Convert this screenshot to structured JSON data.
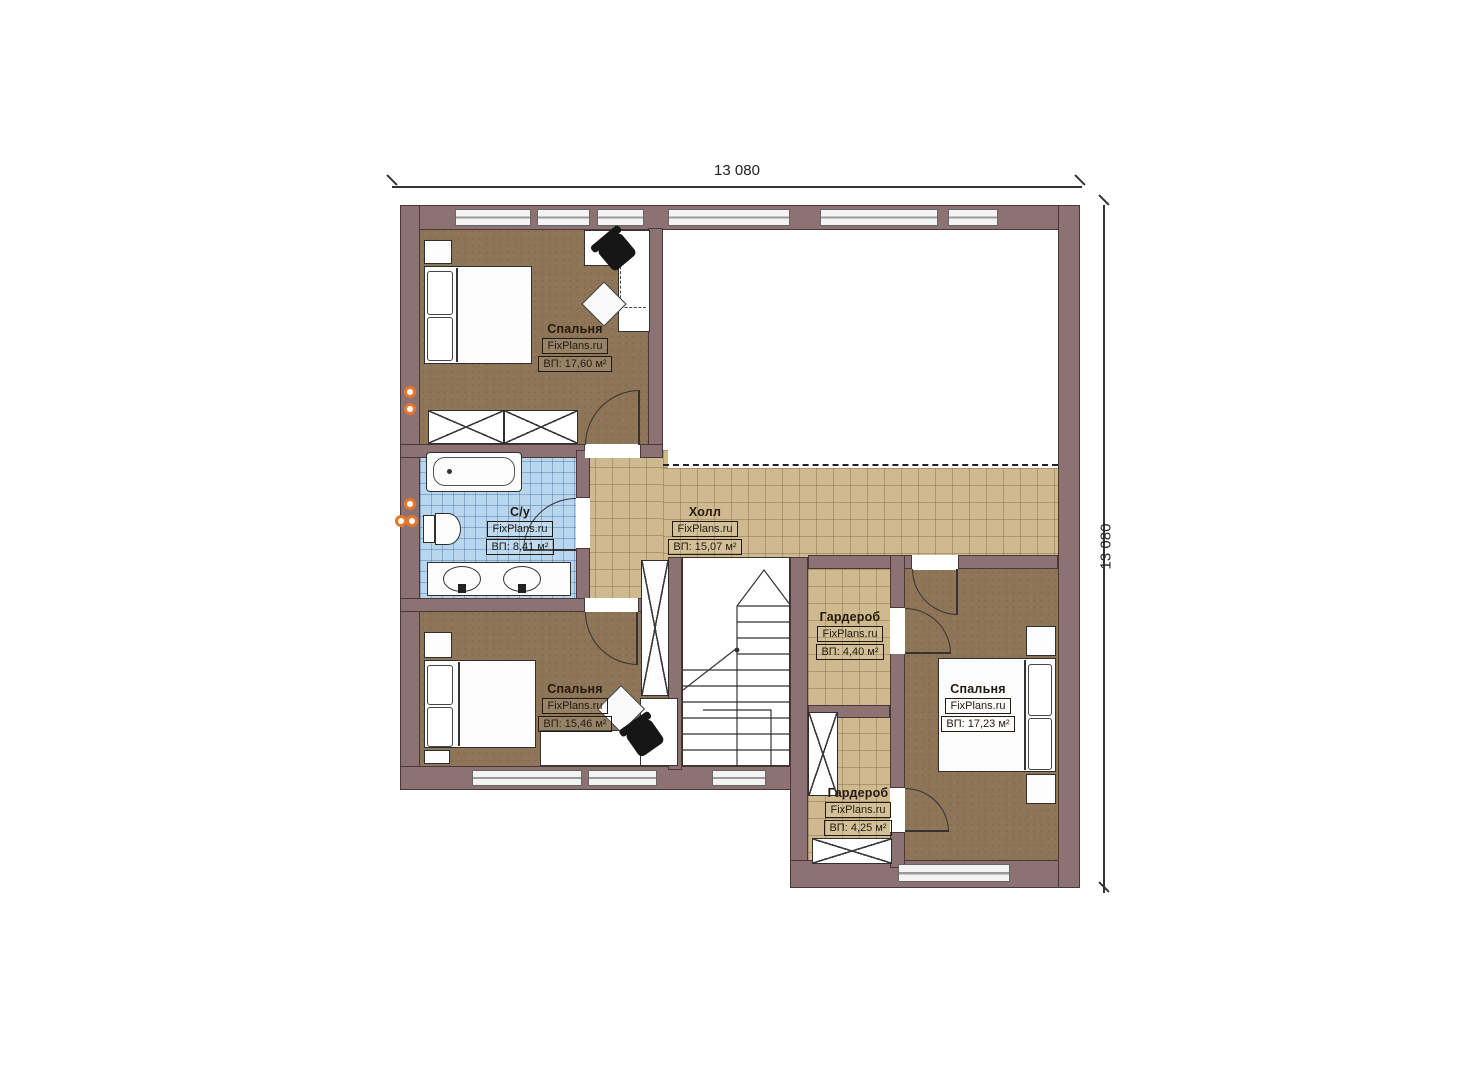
{
  "brand": "FixPlans.ru",
  "dimensions": {
    "top": "13 080",
    "right": "13 080"
  },
  "rooms": [
    {
      "key": "bedroom_top_left",
      "name": "Спальня",
      "brand": "FixPlans.ru",
      "area": "ВП: 17,60 м²"
    },
    {
      "key": "bathroom",
      "name": "С/у",
      "brand": "FixPlans.ru",
      "area": "ВП: 8,41 м²"
    },
    {
      "key": "hall",
      "name": "Холл",
      "brand": "FixPlans.ru",
      "area": "ВП: 15,07 м²"
    },
    {
      "key": "wardrobe_top",
      "name": "Гардероб",
      "brand": "FixPlans.ru",
      "area": "ВП: 4,40 м²"
    },
    {
      "key": "bedroom_bottom_left",
      "name": "Спальня",
      "brand": "FixPlans.ru",
      "area": "ВП: 15,46 м²"
    },
    {
      "key": "bedroom_right",
      "name": "Спальня",
      "brand": "FixPlans.ru",
      "area": "ВП: 17,23 м²"
    },
    {
      "key": "wardrobe_bottom",
      "name": "Гардероб",
      "brand": "FixPlans.ru",
      "area": "ВП: 4,25 м²"
    }
  ],
  "colors": {
    "wall": "#8c7272",
    "wood_floor": "#8e7557",
    "tile_floor": "#cfb98e",
    "bath_tile": "#b9d6ef",
    "accent_orange": "#e8762d"
  }
}
